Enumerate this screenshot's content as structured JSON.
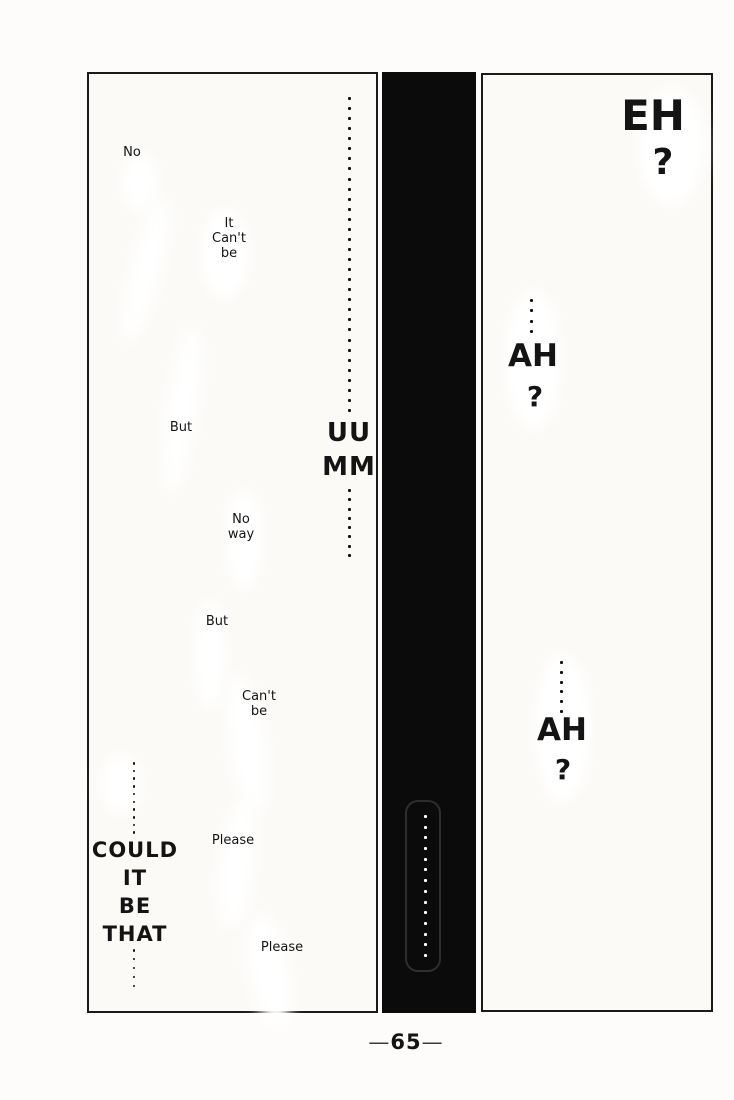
{
  "left_panel": {
    "no": "No",
    "it_cant_be": {
      "l1": "It",
      "l2": "Can't",
      "l3": "be"
    },
    "but_1": "But",
    "uumm": {
      "l1": "UU",
      "l2": "MM"
    },
    "no_way": {
      "l1": "No",
      "l2": "way"
    },
    "but_2": "But",
    "cant_be": {
      "l1": "Can't",
      "l2": "be"
    },
    "please_1": "Please",
    "could_it_be_that": {
      "l1": "COULD",
      "l2": "IT",
      "l3": "BE",
      "l4": "THAT"
    },
    "please_2": "Please",
    "ellipsis": {
      "top_column": 32,
      "below_uumm": 8,
      "above_could": 10,
      "below_that": 5
    }
  },
  "gutter": {
    "bar_color": "#0b0b0b",
    "bubble_dot_color": "#ffffff",
    "bubble_ellipsis": 14
  },
  "right_panel": {
    "eh": {
      "text": "EH",
      "q": "?"
    },
    "ah_1": {
      "text": "AH",
      "q": "?"
    },
    "ah_2": {
      "text": "AH",
      "q": "?"
    },
    "ellipsis": {
      "above_ah_1": 4,
      "above_ah_2": 6
    }
  },
  "footer": {
    "page_number_prefix": "—",
    "page_number": "65",
    "page_number_suffix": "—"
  },
  "colors": {
    "ink": "#141414",
    "paper": "#fbfaf7"
  }
}
